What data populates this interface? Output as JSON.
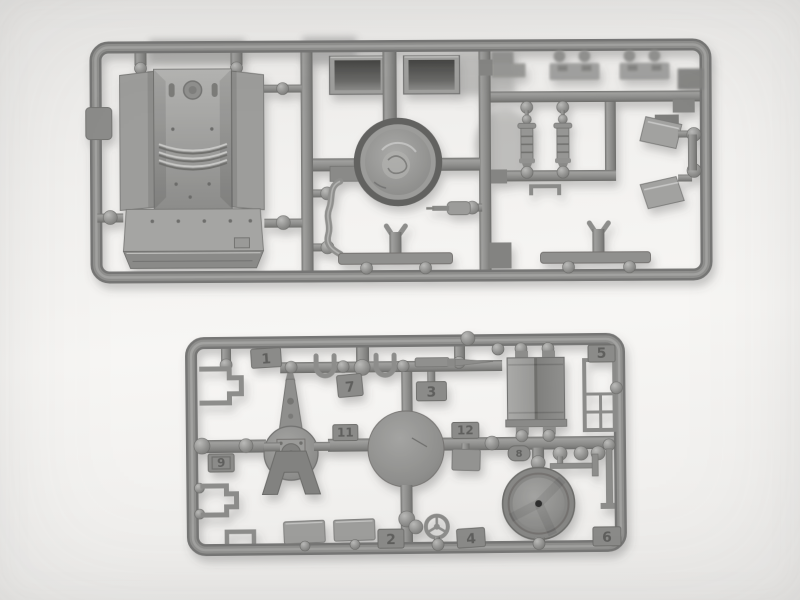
{
  "photo": {
    "background_color": "#f2f1ef",
    "plastic_color": "#8f8f8d",
    "plastic_dark": "#6d6d6b",
    "plastic_light": "#a8a8a6",
    "sprues": {
      "upper": {
        "part_numbers": {}
      },
      "lower": {
        "part_numbers": {
          "n1": "1",
          "n2": "2",
          "n3": "3",
          "n4": "4",
          "n5": "5",
          "n6": "6",
          "n7": "7",
          "n8": "8",
          "n9": "9",
          "n11": "11",
          "n12": "12"
        }
      }
    }
  }
}
